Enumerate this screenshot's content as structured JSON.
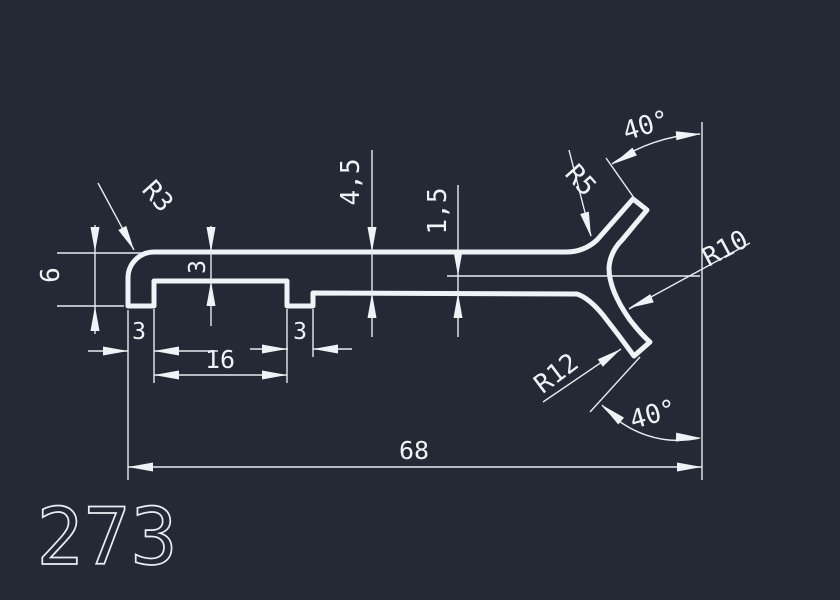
{
  "drawing": {
    "title": "profile-cross-section",
    "part_number": "273",
    "colors": {
      "background": "#242a35",
      "line": "#eff2f6"
    },
    "dimensions": {
      "radius_top_left": "R3",
      "height_left": "6",
      "web_thickness": "3",
      "thickness_main": "4,5",
      "thickness_branch": "1,5",
      "radius_upper_fillet": "R5",
      "angle_upper": "40°",
      "radius_inner": "R10",
      "radius_lower_outer": "R12",
      "angle_lower": "40°",
      "overall_length": "68",
      "recess_width": "16",
      "foot_left_width": "3",
      "foot_right_width": "3"
    }
  }
}
